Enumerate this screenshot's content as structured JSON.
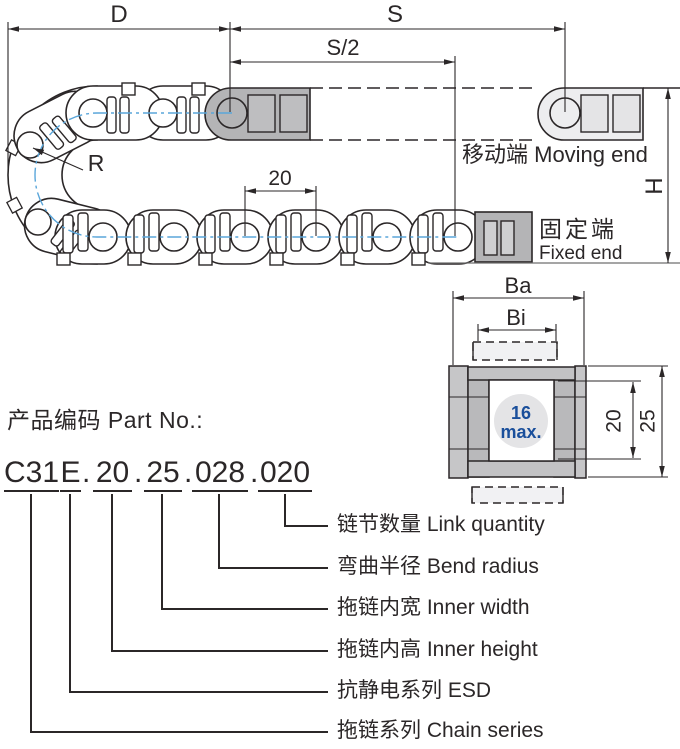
{
  "drawing": {
    "dim_d": "D",
    "dim_s": "S",
    "dim_s_half": "S/2",
    "dim_r": "R",
    "pitch": "20",
    "dim_h": "H",
    "moving_end_label": "移动端 Moving end",
    "fixed_end_label_cn": "固定端",
    "fixed_end_label_en": "Fixed end"
  },
  "cross_section": {
    "dim_ba": "Ba",
    "dim_bi": "Bi",
    "cable_max_value": "16",
    "cable_max_suffix": "max.",
    "inner_height": "20",
    "outer_height": "25"
  },
  "part_no": {
    "heading": "产品编码 Part No.:",
    "separator": ".",
    "segments": [
      {
        "code": "C31",
        "label": "拖链系列 Chain series"
      },
      {
        "code": "E",
        "label": "抗静电系列 ESD"
      },
      {
        "code": "20",
        "label": "拖链内高 Inner height"
      },
      {
        "code": "25",
        "label": "拖链内宽 Inner width"
      },
      {
        "code": "028",
        "label": "弯曲半径 Bend radius"
      },
      {
        "code": "020",
        "label": "链节数量 Link quantity"
      }
    ]
  },
  "colors": {
    "line": "#2b2728",
    "centerline_blue": "#5aa6da",
    "accent_blue": "#1a4f9b",
    "dark_gray": "#b4b4b6",
    "light_gray": "#ededef",
    "plate_gray": "#c2c2c4",
    "hole_gray": "#e4e4e6"
  }
}
